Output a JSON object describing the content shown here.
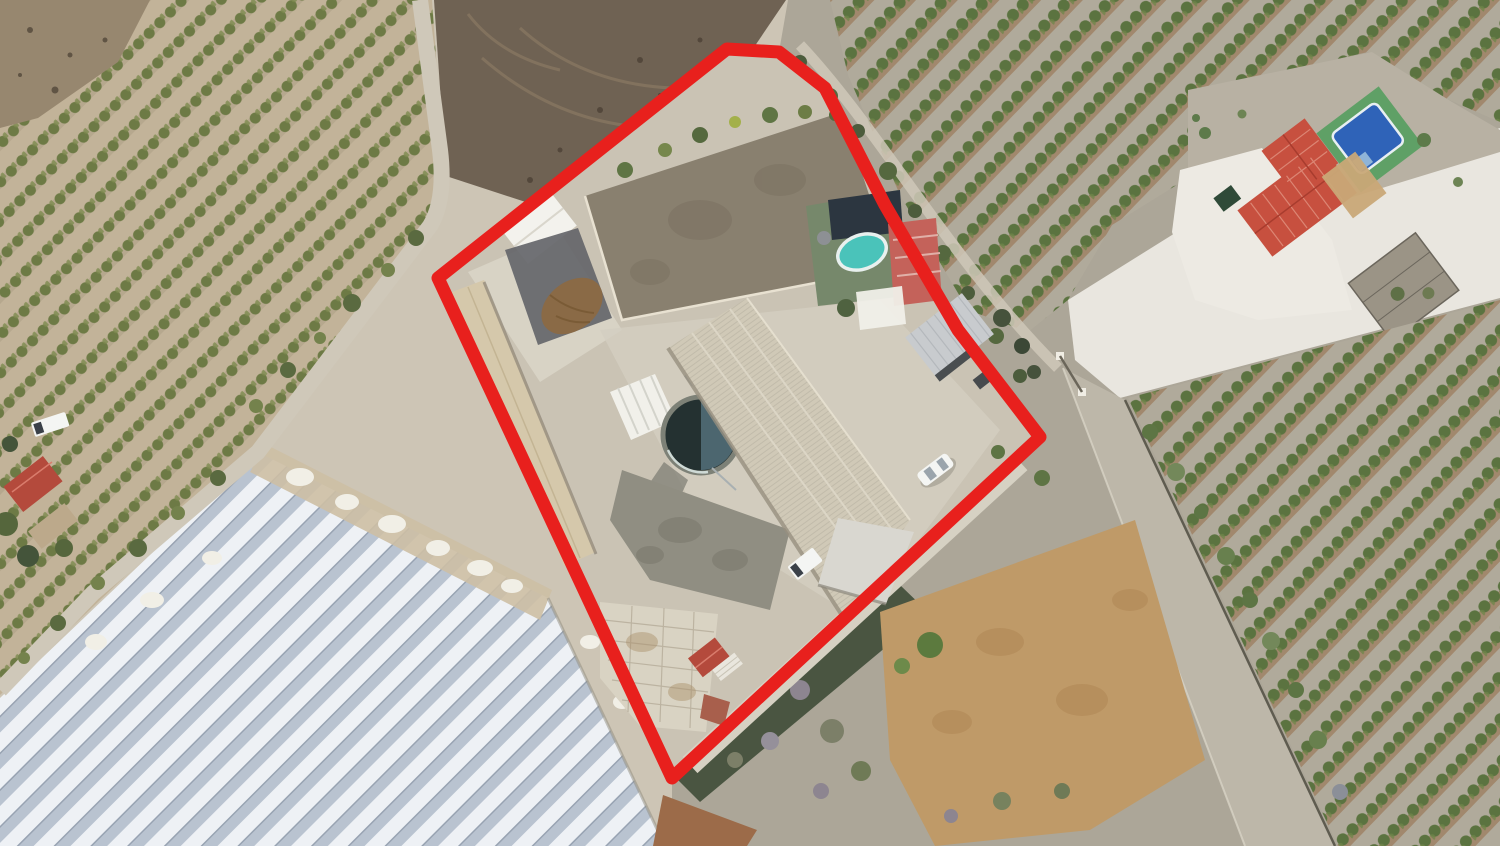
{
  "scene": {
    "type": "aerial-drone-photograph",
    "description": "Top-down aerial photo of a rural farm property outlined with a thick red boundary line, surrounded by olive orchards, a plowed field, large white greenhouses, dirt roads and a neighbouring country house with a swimming pool",
    "annotation": "red property boundary outline"
  },
  "colors": {
    "boundary": "#e8201d",
    "ground": "#cdc5b5",
    "yard": "#cac3b4",
    "concrete_bright": "#d8d3c5",
    "scrub": "#aca698",
    "field_dark": "#6f6253",
    "road": "#cfc8b9",
    "road_right": "#bdb7a9",
    "white_road": "#e9e6df",
    "clearing": "#b8b1a3",
    "paddock": "#89806f",
    "shed_white": "#f3f2ed",
    "dark_ground": "#65666a",
    "manure": "#8a6a46",
    "barn_roof": "#d5c8ab",
    "main_roof": "#d0c9b7",
    "wing_roof": "#d9d7d0",
    "shed_gray": "#c8cbce",
    "tank_rim": "#7d8177",
    "tank_water": "#243131",
    "tank_light": "#54707a",
    "deck_green": "#76886b",
    "deck_navy": "#2c3640",
    "pool_water": "#4ac3ba",
    "poolhouse_roof": "#c4625a",
    "car_white": "#f4f5f3",
    "house_roof": "#c7503f",
    "terrace": "#edeae3",
    "terrace_tan": "#c9a877",
    "pool_blue": "#2f63b8",
    "deck_bright": "#5fa066",
    "hedge": "#414e3a",
    "dirt_orange": "#bf9a68",
    "dirt_red": "#9c6b49",
    "house2_roof": "#b44a3c"
  },
  "shapes": {
    "boundary": "727,49 779,52 825,88 885,205 958,330 1040,437 672,778 438,278",
    "scrub_right": "672,778 1040,437 958,330 885,205 825,88 779,52 788,0 1500,0 1500,846 672,846",
    "orchard_left": "0,0 432,0 446,198 430,228 258,450 0,695",
    "bare_corner": "0,0 150,0 118,62 38,118 0,128",
    "field": "434,0 786,0 744,62 544,208 446,176",
    "greenhouse": "0,698 258,452 548,598 665,846 0,846",
    "gh_dirt_band": "265,444 552,590 540,620 250,472",
    "orchard_topright": "830,0 1500,0 1500,122 1438,95 1368,52 1195,92 1188,178 1112,225 1068,300 1028,332 968,310 900,195 848,75",
    "white_road": "1068,300 1188,225 1500,128 1500,298 1120,398 1075,360",
    "clearing": "1188,90 1372,52 1452,102 1500,130 1500,152 1310,210 1188,178",
    "terrace": "1180,170 1262,148 1332,240 1352,310 1258,320 1195,300 1172,232",
    "road_d": "1063,368 1125,400 1335,846 1245,846",
    "orchard_right": "1500,300 1128,398 1338,846 1500,846",
    "orange_field": "880,612 1135,520 1205,760 1090,830 935,846 890,760",
    "hedge": "668,770 900,585 928,612 700,802",
    "dirt_red_patch": "663,795 757,830 747,846 653,846",
    "paddock": "585,196 842,112 893,268 622,320",
    "main_roof": "747,298 910,520 843,617 668,348",
    "barn_roof": "452,292 484,280 596,552 564,566",
    "wing_roof": "838,518 914,532 886,604 818,585",
    "dark_patch": "622,470 700,498 790,530 770,610 650,580 610,520",
    "dark_ground": "505,250 578,228 612,318 538,345",
    "concrete_pad": "600,602 718,614 706,732 640,726 600,678",
    "upper_concrete": "468,272 560,232 622,330 540,382",
    "lane_left": "M 420,0 L 440,150 Q 446,200 430,226 L 258,452 L 93,593 L 0,690",
    "lane_top": "M 800,45 C 880,130 950,260 1058,368",
    "drive_inner": "M 690,765 L 1020,462"
  }
}
